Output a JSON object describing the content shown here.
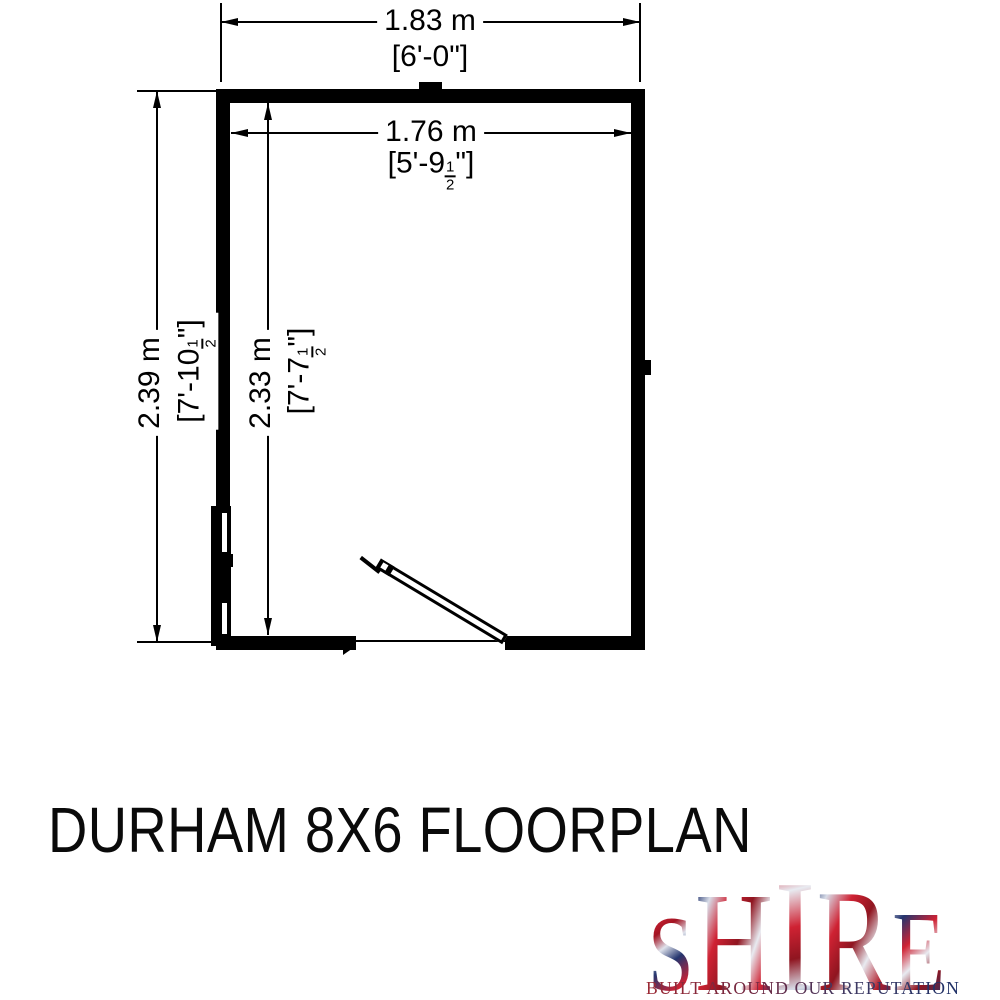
{
  "title": "DURHAM 8X6 FLOORPLAN",
  "drawing": {
    "line_color": "#000000",
    "background": "#ffffff",
    "door": "single door, hinged right of opening, swinging outward",
    "window": "glazed window on left wall"
  },
  "dims": {
    "outer_width": {
      "metric": "1.83 m",
      "imperial": "[6'-0\"]"
    },
    "inner_width": {
      "metric": "1.76 m",
      "imp_pre": "[5'-9",
      "frac_num": "1",
      "frac_den": "2",
      "imp_post": "\"]"
    },
    "outer_depth": {
      "metric": "2.39 m",
      "imp_pre": "[7'-10",
      "frac_num": "1",
      "frac_den": "2",
      "imp_post": "\"]"
    },
    "inner_depth": {
      "metric": "2.33 m",
      "imp_pre": "[7'-7",
      "frac_num": "1",
      "frac_den": "2",
      "imp_post": "\"]"
    }
  },
  "logo": {
    "letters": [
      "S",
      "H",
      "I",
      "R",
      "E"
    ],
    "tagline": "BUILT AROUND OUR REPUTATION",
    "flag_red": "#cf2233",
    "flag_blue": "#24356e"
  }
}
